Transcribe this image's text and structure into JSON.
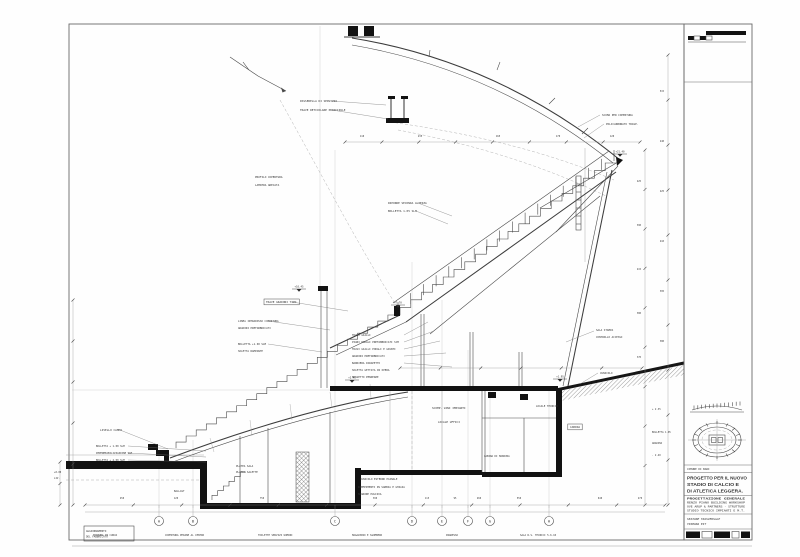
{
  "sheet": {
    "kind": "architectural cross-section drawing",
    "subject": "grandstand / stadium section with stair and basement rooms"
  },
  "titleblock": {
    "municipality": "COMUNE DI BARI",
    "title_line1": "PROGETTO PER IL NUOVO",
    "title_line2": "STADIO DI CALCIO E",
    "title_line3": "DI ATLETICA LEGGERA.",
    "credits": [
      "PROGETTAZIONE GENERALE",
      "RENZO PIANO BUILDING WORKSHOP",
      "OVE ARUP & PARTNERS - STRUTTURE",
      "STUDIO TECNICO IMPIANTI E M.T."
    ],
    "note_line1": "SEZIONE TRASVERSALE",
    "note_line2": "TRIBUNA EST"
  },
  "corner_box": {
    "line1": "AGGIORNAMENTO",
    "line2": "DEL FABBRICATO"
  },
  "grid_bubbles": [
    {
      "letter": "A",
      "x": 159
    },
    {
      "letter": "B",
      "x": 193
    },
    {
      "letter": "C",
      "x": 335
    },
    {
      "letter": "D",
      "x": 412
    },
    {
      "letter": "E",
      "x": 442
    },
    {
      "letter": "F",
      "x": 468
    },
    {
      "letter": "G",
      "x": 490
    },
    {
      "letter": "H",
      "x": 549
    }
  ],
  "bottom_labels": [
    {
      "x": 93,
      "t": "TRIBUNA IN CURVA"
    },
    {
      "x": 165,
      "t": "COPERTURA PEDANE AL CENTRO"
    },
    {
      "x": 258,
      "t": "TOILETTE SERVIZI UOMINI"
    },
    {
      "x": 352,
      "t": "MAGAZZINO E SGOMBERO"
    },
    {
      "x": 446,
      "t": "INGRESSO"
    },
    {
      "x": 520,
      "t": "SALA R.S. TECNICI 5.6.10"
    }
  ],
  "flags": [
    {
      "x": 299,
      "y": 289,
      "t": "+10.45"
    },
    {
      "x": 398,
      "y": 305,
      "t": "+7.70"
    },
    {
      "x": 352,
      "y": 380,
      "t": "+2.45"
    },
    {
      "x": 560,
      "y": 379,
      "t": "+1.95"
    },
    {
      "x": 620,
      "y": 154,
      "t": "+21.40"
    }
  ],
  "annotations": [
    {
      "x": 300,
      "y": 102,
      "t": "PASSERELLA DI SERVIZIO",
      "s": 2.8
    },
    {
      "x": 300,
      "y": 111,
      "t": "TRAVE RETICOLARE PRINCIPALE",
      "s": 2.8
    },
    {
      "x": 602,
      "y": 116,
      "t": "SCOMA PER COPERTURA",
      "s": 2.7
    },
    {
      "x": 606,
      "y": 125,
      "t": "POLICARBONATO TRASP.",
      "s": 2.7
    },
    {
      "x": 362,
      "y": 137,
      "t": "110",
      "s": 2.4,
      "a": "middle"
    },
    {
      "x": 420,
      "y": 137,
      "t": "235",
      "s": 2.4,
      "a": "middle"
    },
    {
      "x": 498,
      "y": 137,
      "t": "165",
      "s": 2.4,
      "a": "middle"
    },
    {
      "x": 558,
      "y": 137,
      "t": "170",
      "s": 2.4,
      "a": "middle"
    },
    {
      "x": 612,
      "y": 137,
      "t": "120",
      "s": 2.4,
      "a": "middle"
    },
    {
      "x": 255,
      "y": 178,
      "t": "PROFILO COPERTURA",
      "s": 2.7
    },
    {
      "x": 255,
      "y": 186,
      "t": "LAMIERA GRECATA",
      "s": 2.7
    },
    {
      "x": 388,
      "y": 204,
      "t": "RIPORRE SECONDA ALTEZZA",
      "s": 2.8
    },
    {
      "x": 388,
      "y": 212,
      "t": "BOLLETTA 1.05 SLM",
      "s": 2.8
    },
    {
      "x": 266,
      "y": 303,
      "t": "TRAVE GRADONI TIPO",
      "s": 2.8,
      "box": true
    },
    {
      "x": 238,
      "y": 322,
      "t": "LINEA INTRADOSSO COPERTURA",
      "s": 2.6
    },
    {
      "x": 238,
      "y": 329,
      "t": "GRADONI PREFABBRICATI",
      "s": 2.6
    },
    {
      "x": 238,
      "y": 345,
      "t": "BOLLETTA +1.00 SLM",
      "s": 2.6
    },
    {
      "x": 238,
      "y": 352,
      "t": "SOLETTA RAMPANTE",
      "s": 2.6
    },
    {
      "x": 352,
      "y": 336,
      "t": "TRAVI GIALLI",
      "s": 2.6
    },
    {
      "x": 352,
      "y": 343,
      "t": "PIANI PODALI PREFABBRICATI SCM",
      "s": 2.6
    },
    {
      "x": 352,
      "y": 350,
      "t": "TRAVI GIALLI PODALI E GIUNTI",
      "s": 2.6
    },
    {
      "x": 352,
      "y": 357,
      "t": "GRADONI PREFABBRICATI",
      "s": 2.6
    },
    {
      "x": 352,
      "y": 364,
      "t": "BARRIERA PARAPETTO",
      "s": 2.6
    },
    {
      "x": 352,
      "y": 371,
      "t": "SOLETTA GETTATA IN OPERA",
      "s": 2.6
    },
    {
      "x": 352,
      "y": 378,
      "t": "MASSETTO PENDENZE",
      "s": 2.6
    },
    {
      "x": 432,
      "y": 409,
      "t": "SCOMP. VANI IMPIANTI",
      "s": 2.8
    },
    {
      "x": 438,
      "y": 423,
      "t": "LOCALE UFFICI",
      "s": 2.8
    },
    {
      "x": 536,
      "y": 407,
      "t": "LOCALE TECNICO",
      "s": 2.6
    },
    {
      "x": 575,
      "y": 428,
      "t": "CABINA",
      "s": 2.8,
      "box": true,
      "a": "middle"
    },
    {
      "x": 484,
      "y": 457,
      "t": "CABINA DI MANOVRA",
      "s": 2.5
    },
    {
      "x": 360,
      "y": 480,
      "t": "CUNICOLO ESTERNO PIANALE",
      "s": 2.6
    },
    {
      "x": 358,
      "y": 488,
      "t": "RIEMPIMENTO IN SABBIA E GHIAIA",
      "s": 2.6
    },
    {
      "x": 358,
      "y": 495,
      "t": "MAGRONE PULIZIA",
      "s": 2.6
    },
    {
      "x": 236,
      "y": 467,
      "t": "PLATEA SALA",
      "s": 2.6
    },
    {
      "x": 236,
      "y": 473,
      "t": "PLATEA SALETTE",
      "s": 2.6
    },
    {
      "x": 100,
      "y": 431,
      "t": "LIVELLO CAMPO",
      "s": 2.8
    },
    {
      "x": 96,
      "y": 447,
      "t": "BOLLETTA + 1.00 SLM",
      "s": 2.5
    },
    {
      "x": 96,
      "y": 454,
      "t": "IMPERMEABILIZZAZIONE SLM",
      "s": 2.5
    },
    {
      "x": 96,
      "y": 461,
      "t": "BOLLETTA + 4.00 SLM",
      "s": 2.5
    },
    {
      "x": 54,
      "y": 473,
      "t": "+0.00",
      "s": 2.4
    },
    {
      "x": 54,
      "y": 479,
      "t": "LIV.",
      "s": 2.4
    },
    {
      "x": 174,
      "y": 492,
      "t": "BALLAST",
      "s": 2.5
    },
    {
      "x": 596,
      "y": 331,
      "t": "SALA STAMPA",
      "s": 2.6
    },
    {
      "x": 596,
      "y": 338,
      "t": "CONTROLLO ACCESSI",
      "s": 2.6
    },
    {
      "x": 600,
      "y": 374,
      "t": "CUNICOLO",
      "s": 2.6
    },
    {
      "x": 652,
      "y": 410,
      "t": "+ 2.35",
      "s": 2.4
    },
    {
      "x": 652,
      "y": 433,
      "t": "BOLLETTA 1.05",
      "s": 2.4
    },
    {
      "x": 652,
      "y": 444,
      "t": "GRADINI",
      "s": 2.4
    },
    {
      "x": 652,
      "y": 456,
      "t": "- 2.40",
      "s": 2.4
    },
    {
      "x": 641,
      "y": 182,
      "t": "425",
      "s": 2.3,
      "a": "end"
    },
    {
      "x": 641,
      "y": 226,
      "t": "390",
      "s": 2.3,
      "a": "end"
    },
    {
      "x": 641,
      "y": 270,
      "t": "415",
      "s": 2.3,
      "a": "end"
    },
    {
      "x": 641,
      "y": 314,
      "t": "380",
      "s": 2.3,
      "a": "end"
    },
    {
      "x": 641,
      "y": 358,
      "t": "370",
      "s": 2.3,
      "a": "end"
    },
    {
      "x": 664,
      "y": 92,
      "t": "515",
      "s": 2.3,
      "a": "end"
    },
    {
      "x": 664,
      "y": 142,
      "t": "440",
      "s": 2.3,
      "a": "end"
    },
    {
      "x": 664,
      "y": 192,
      "t": "425",
      "s": 2.3,
      "a": "end"
    },
    {
      "x": 664,
      "y": 242,
      "t": "410",
      "s": 2.3,
      "a": "end"
    },
    {
      "x": 664,
      "y": 292,
      "t": "395",
      "s": 2.3,
      "a": "end"
    },
    {
      "x": 664,
      "y": 342,
      "t": "380",
      "s": 2.3,
      "a": "end"
    },
    {
      "x": 122,
      "y": 499,
      "t": "450",
      "s": 2.3,
      "a": "middle"
    },
    {
      "x": 176,
      "y": 499,
      "t": "120",
      "s": 2.3,
      "a": "middle"
    },
    {
      "x": 262,
      "y": 499,
      "t": "750",
      "s": 2.3,
      "a": "middle"
    },
    {
      "x": 375,
      "y": 499,
      "t": "390",
      "s": 2.3,
      "a": "middle"
    },
    {
      "x": 427,
      "y": 499,
      "t": "115",
      "s": 2.3,
      "a": "middle"
    },
    {
      "x": 455,
      "y": 499,
      "t": "95",
      "s": 2.3,
      "a": "middle"
    },
    {
      "x": 479,
      "y": 499,
      "t": "260",
      "s": 2.3,
      "a": "middle"
    },
    {
      "x": 519,
      "y": 499,
      "t": "550",
      "s": 2.3,
      "a": "middle"
    },
    {
      "x": 600,
      "y": 499,
      "t": "640",
      "s": 2.3,
      "a": "middle"
    },
    {
      "x": 640,
      "y": 499,
      "t": "270",
      "s": 2.3,
      "a": "middle"
    }
  ],
  "leaders": [
    [
      332,
      101,
      386,
      105
    ],
    [
      332,
      110,
      388,
      119
    ],
    [
      600,
      115,
      578,
      127
    ],
    [
      604,
      124,
      584,
      138
    ],
    [
      418,
      203,
      452,
      216
    ],
    [
      416,
      211,
      448,
      224
    ],
    [
      292,
      302,
      348,
      311
    ],
    [
      268,
      321,
      330,
      330
    ],
    [
      268,
      344,
      322,
      352
    ],
    [
      120,
      430,
      168,
      449
    ],
    [
      128,
      446,
      206,
      451
    ],
    [
      128,
      453,
      206,
      457
    ],
    [
      128,
      460,
      206,
      462
    ],
    [
      404,
      335,
      428,
      322
    ],
    [
      404,
      342,
      434,
      331
    ],
    [
      404,
      349,
      440,
      341
    ],
    [
      404,
      356,
      446,
      353
    ],
    [
      404,
      363,
      452,
      367
    ],
    [
      594,
      331,
      566,
      342
    ],
    [
      598,
      373,
      580,
      384
    ]
  ]
}
